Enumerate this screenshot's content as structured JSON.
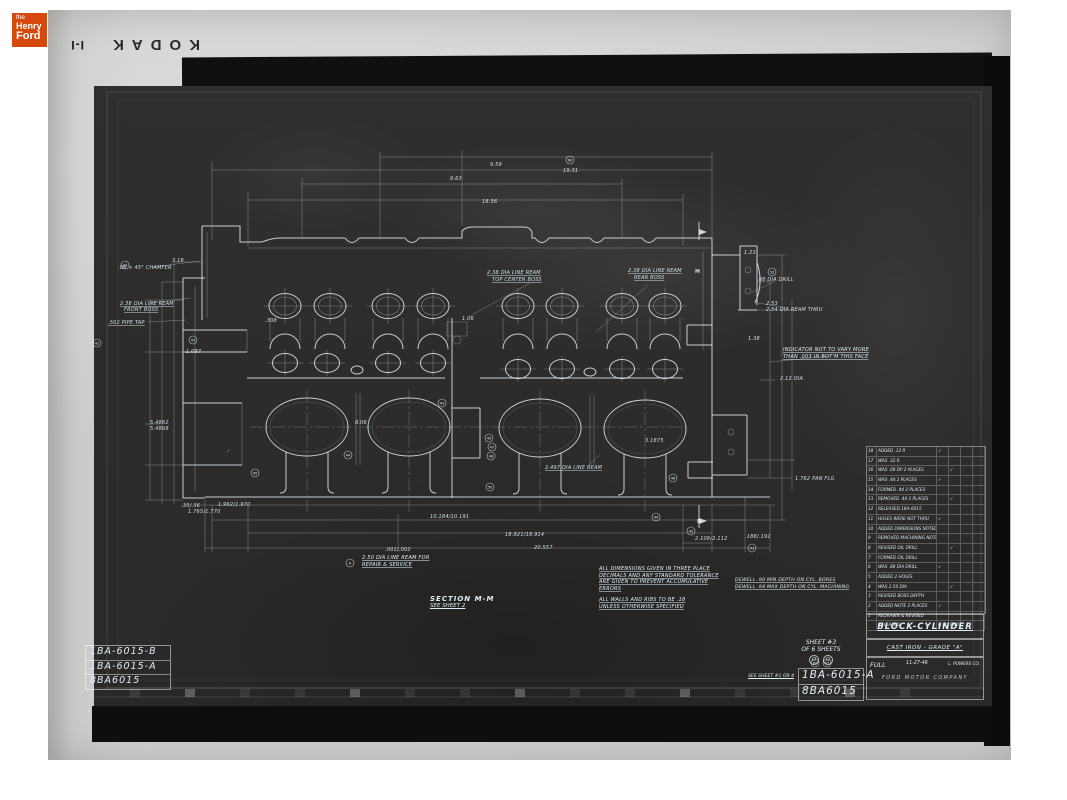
{
  "colors": {
    "logo_orange": "#d5490f",
    "film_gray": "#cecece",
    "negative": "#2d2d2d",
    "line_white": "#dfeaf0"
  },
  "branding": {
    "the": "the",
    "henry": "Henry",
    "ford": "Ford"
  },
  "film": {
    "brand": "KODAK",
    "frame_mark": "I-I"
  },
  "left_part_stack": {
    "rows": [
      "1BA-6015-B",
      "1BA-6015-A",
      "8BA6015"
    ]
  },
  "part_stamp": {
    "rows": [
      "1BA-6015-A",
      "8BA6015"
    ]
  },
  "sheet_info": {
    "line1": "SHEET #3",
    "line2": "OF 6 SHEETS",
    "marks": [
      "O",
      "O"
    ],
    "see_ref": "SEE SHEET #1 OR 4"
  },
  "title_block": {
    "title": "BLOCK-CYLINDER",
    "material": "CAST IRON - GRADE \"A\"",
    "scale_label": "FULL",
    "date": "11-27-46",
    "drafts": "L. POWERS CO.",
    "company": "FORD MOTOR COMPANY"
  },
  "section_note": {
    "line1": "SECTION  M-M",
    "line2": "SEE SHEET 2"
  },
  "notes": {
    "repair": [
      "2.50 DIA LINE REAM FOR",
      "REPAIR & SERVICE"
    ],
    "tolerance": [
      "ALL DIMENSIONS GIVEN IN THREE PLACE",
      "DECIMALS AND ANY STANDARD TOLERANCE",
      "ARE GIVEN TO PREVENT ACCUMULATIVE",
      "ERRORS"
    ],
    "walls": [
      "ALL WALLS AND RIBS TO BE .18",
      "UNLESS OTHERWISE SPECIFIED"
    ],
    "dwell": [
      "DEWELL .90 MIN DEPTH ON CYL. BORES",
      "DEWELL .94 MAX DEPTH ON CYL. MACHINING"
    ],
    "indicator": [
      "INDICATOR NOT TO VARY MORE",
      "THAN .003 IN BOT'M THIS FACE"
    ]
  },
  "revision_table": {
    "rows": [
      {
        "no": "18",
        "t": "ADDED .12 R",
        "c1": "✓",
        "c2": ""
      },
      {
        "no": "17",
        "t": "WAS .32 R",
        "c1": "",
        "c2": ""
      },
      {
        "no": "16",
        "t": "WAS .08 DP 2 PLACES",
        "c1": "",
        "c2": "✓"
      },
      {
        "no": "15",
        "t": "WAS .44  2 PLACES",
        "c1": "✓",
        "c2": ""
      },
      {
        "no": "14",
        "t": "FORMED .44  2 PLACES",
        "c1": "",
        "c2": ""
      },
      {
        "no": "13",
        "t": "REMOVED .44  2 PLACES",
        "c1": "",
        "c2": "✓"
      },
      {
        "no": "12",
        "t": "RELEASED  18A-6015",
        "c1": "",
        "c2": ""
      },
      {
        "no": "11",
        "t": "HOLES WERE NOT THRU",
        "c1": "✓",
        "c2": ""
      },
      {
        "no": "10",
        "t": "ADDED DIMENSIONS NOTED",
        "c1": "",
        "c2": ""
      },
      {
        "no": "9",
        "t": "REMOVED MACHINING NOTE",
        "c1": "",
        "c2": ""
      },
      {
        "no": "8",
        "t": "REVISED OIL DRILL",
        "c1": "",
        "c2": "✓"
      },
      {
        "no": "7",
        "t": "FORMED OIL DRILL",
        "c1": "",
        "c2": ""
      },
      {
        "no": "6",
        "t": "WAS .88 DIA DRILL",
        "c1": "✓",
        "c2": ""
      },
      {
        "no": "5",
        "t": "ADDED 2 HOLES",
        "c1": "",
        "c2": ""
      },
      {
        "no": "4",
        "t": "WAS 2.50 DIA",
        "c1": "",
        "c2": "✓"
      },
      {
        "no": "3",
        "t": "REVISED BOSS DEPTH",
        "c1": "",
        "c2": ""
      },
      {
        "no": "2",
        "t": "ADDED NOTE  2 PLACES",
        "c1": "✓",
        "c2": ""
      },
      {
        "no": "1",
        "t": "REDRAWN & REVISED",
        "c1": "",
        "c2": ""
      },
      {
        "no": "",
        "t": "RELEASED",
        "c1": "B.W.",
        "c2": "BROWN"
      }
    ]
  },
  "drawing": {
    "labels": [
      {
        "x": 118,
        "y": 269,
        "t": ".06 × 45° CHAMFER"
      },
      {
        "x": 120,
        "y": 305,
        "t": "2.38 DIA LINE REAM",
        "u": 1
      },
      {
        "x": 124,
        "y": 311,
        "t": "FRONT BOSS",
        "u": 1
      },
      {
        "x": 108,
        "y": 324,
        "t": ".502 PIPE TAP",
        "u": 1
      },
      {
        "x": 172,
        "y": 262,
        "t": "3.18"
      },
      {
        "x": 186,
        "y": 353,
        "t": "1.087"
      },
      {
        "x": 150,
        "y": 424,
        "t": "5.4862"
      },
      {
        "x": 150,
        "y": 430,
        "t": "5.4868"
      },
      {
        "x": 265,
        "y": 322,
        "t": ".308"
      },
      {
        "x": 462,
        "y": 320,
        "t": "1.06"
      },
      {
        "x": 487,
        "y": 274,
        "t": "2.38 DIA LINE REAM",
        "u": 1
      },
      {
        "x": 492,
        "y": 281,
        "t": "TOP CENTER BOSS",
        "u": 1
      },
      {
        "x": 628,
        "y": 272,
        "t": "2.38 DIA LINE REAM",
        "u": 1
      },
      {
        "x": 634,
        "y": 279,
        "t": "REAR BOSS",
        "u": 1
      },
      {
        "x": 757,
        "y": 281,
        "t": ".88 DIA DRILL"
      },
      {
        "x": 766,
        "y": 305,
        "t": "2.53"
      },
      {
        "x": 766,
        "y": 311,
        "t": "2.54 DIA REAM THRU"
      },
      {
        "x": 695,
        "y": 273,
        "t": "M",
        "fs": 7,
        "b": 1
      },
      {
        "x": 697,
        "y": 523,
        "t": "M",
        "fs": 7,
        "b": 1
      },
      {
        "x": 780,
        "y": 380,
        "t": "2.12 DIA"
      },
      {
        "x": 744,
        "y": 254,
        "t": "1.23"
      },
      {
        "x": 748,
        "y": 340,
        "t": "1.38"
      },
      {
        "x": 490,
        "y": 166,
        "t": "9.59"
      },
      {
        "x": 563,
        "y": 172,
        "t": "19.31"
      },
      {
        "x": 450,
        "y": 180,
        "t": "9.63"
      },
      {
        "x": 482,
        "y": 203,
        "t": "18.56"
      },
      {
        "x": 355,
        "y": 424,
        "t": "8.06"
      },
      {
        "x": 645,
        "y": 442,
        "t": "3.1875"
      },
      {
        "x": 545,
        "y": 469,
        "t": "2.497 DIA LINE REAM",
        "u": 1
      },
      {
        "x": 385,
        "y": 551,
        "t": ".001/.002"
      },
      {
        "x": 181,
        "y": 507,
        "t": ".35/.36"
      },
      {
        "x": 188,
        "y": 513,
        "t": "1.765/1.770"
      },
      {
        "x": 218,
        "y": 506,
        "t": "1.962/1.970"
      },
      {
        "x": 430,
        "y": 518,
        "t": "10.184/10.191"
      },
      {
        "x": 505,
        "y": 536,
        "t": "18.921/18.914"
      },
      {
        "x": 534,
        "y": 549,
        "t": "20.557"
      },
      {
        "x": 695,
        "y": 540,
        "t": "2.108/2.112"
      },
      {
        "x": 745,
        "y": 538,
        "t": ".188/.191"
      },
      {
        "x": 795,
        "y": 480,
        "t": "1.762 PAN FLG"
      }
    ],
    "balloons": [
      {
        "x": 570,
        "y": 160,
        "t": "60"
      },
      {
        "x": 125,
        "y": 265,
        "t": "24"
      },
      {
        "x": 97,
        "y": 343,
        "t": "42"
      },
      {
        "x": 193,
        "y": 340,
        "t": "47"
      },
      {
        "x": 348,
        "y": 455,
        "t": "44"
      },
      {
        "x": 255,
        "y": 473,
        "t": "45"
      },
      {
        "x": 442,
        "y": 403,
        "t": "43"
      },
      {
        "x": 489,
        "y": 438,
        "t": "49"
      },
      {
        "x": 492,
        "y": 447,
        "t": "47"
      },
      {
        "x": 491,
        "y": 456,
        "t": "48"
      },
      {
        "x": 490,
        "y": 487,
        "t": "50"
      },
      {
        "x": 673,
        "y": 478,
        "t": "46"
      },
      {
        "x": 772,
        "y": 272,
        "t": "52"
      },
      {
        "x": 656,
        "y": 517,
        "t": "44"
      },
      {
        "x": 691,
        "y": 531,
        "t": "45"
      },
      {
        "x": 752,
        "y": 548,
        "t": "43"
      },
      {
        "x": 350,
        "y": 563,
        "t": "A"
      },
      {
        "x": 815,
        "y": 663,
        "t": "60"
      },
      {
        "x": 827,
        "y": 663,
        "t": "67"
      }
    ]
  }
}
